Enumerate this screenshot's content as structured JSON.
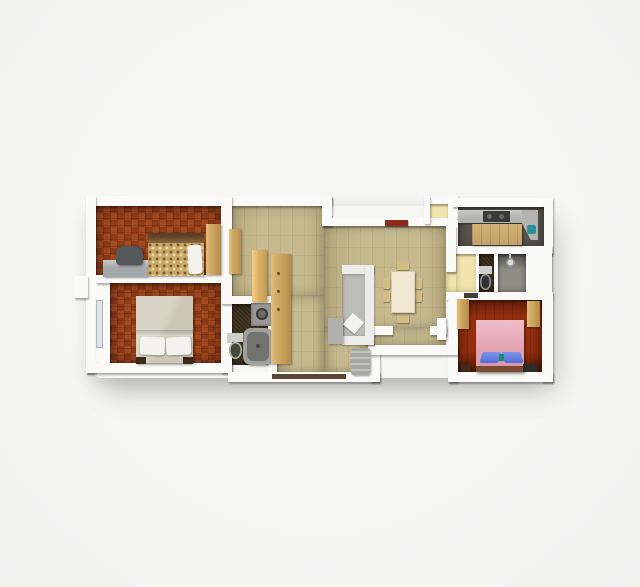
{
  "scene": {
    "kind": "3d-rendered-apartment-floor-plan",
    "background": "#f0f0ef"
  },
  "palette": {
    "wall": "#fafaf8",
    "living": "#c7ba8f",
    "bedLA": "#a34a20",
    "bedLB": "#8e3b17",
    "bedR": "#97300f",
    "bathDark": "#392b1a",
    "kitchen": "#56544c",
    "shower": "#8d8c85",
    "yellow": "#f2e4ae",
    "woodTan": "#d0a963",
    "woodTanLight": "#e2bf7d",
    "woodTanDark": "#b68c48",
    "sofaWhite": "#ececea",
    "sofaGray": "#bdbdb9",
    "chaiseGray": "#b0b0ac",
    "armchairGray": "#a7a7a3",
    "tableCream": "#f1e9d4",
    "chairTan": "#d4bd85",
    "headboardDark": "#5e4026",
    "floralBase": "#c9a868",
    "blanketBeige": "#cdc6b5",
    "blanketLight": "#dad4c6",
    "pillowWhite": "#f3f2ee",
    "bedPink": "#e6aab8",
    "pillowBlue": "#4f6bd8",
    "tealAccent": "#1f8a74",
    "radiatorRed": "#8e2c1c",
    "counterGray": "#b4b5b1",
    "applianceDark": "#3a3a38",
    "sinkTeal": "#2e8f96",
    "washerGray": "#999997",
    "tubGray": "#9fa19e",
    "tubInner": "#71736f",
    "toiletOlive": "#454a3c",
    "toiletDarkSeat": "#2f3234",
    "tankLight": "#cfcfc9",
    "deskGray": "#a3a8ab",
    "deskChairDark": "#54585b",
    "windowGlass": "#dfe6ea",
    "sillDark": "#5a4632",
    "darkFurn": "#2c2c2a"
  },
  "plan": {
    "rooms": [
      {
        "name": "bedroom-top-left",
        "floor": "terracotta-checker"
      },
      {
        "name": "bedroom-bottom-left",
        "floor": "terracotta-checker"
      },
      {
        "name": "bathroom-left",
        "floor": "dark-tile"
      },
      {
        "name": "hallway-entry",
        "floor": "beige-tile"
      },
      {
        "name": "living-dining-room",
        "floor": "beige-tile"
      },
      {
        "name": "pantry-nook",
        "floor": "pale-yellow"
      },
      {
        "name": "kitchen",
        "floor": "dark-gray"
      },
      {
        "name": "hallway-right",
        "floor": "pale-yellow"
      },
      {
        "name": "wc",
        "floor": "dark-tile"
      },
      {
        "name": "shower-room",
        "floor": "gray"
      },
      {
        "name": "bedroom-right",
        "floor": "terracotta-plank"
      }
    ],
    "furniture": [
      "desk",
      "desk-chair",
      "single-bed-floral",
      "wardrobe-small",
      "double-bed-beige",
      "window-left",
      "washing-machine",
      "bathtub",
      "toilet-left",
      "tall-wardrobe",
      "wardrobe-panel",
      "hall-door-panel",
      "l-shaped-sofa",
      "sofa-pillow",
      "chaise",
      "armchair",
      "dining-table",
      "dining-chairs-x6",
      "radiator-red",
      "open-door-white",
      "kitchen-counter",
      "stove",
      "sink-teal",
      "kitchen-island",
      "toilet-right",
      "shower-head",
      "double-bed-pink",
      "blue-pillows",
      "wardrobe-right-a",
      "wardrobe-right-b",
      "tv-unit",
      "nightstand"
    ]
  }
}
